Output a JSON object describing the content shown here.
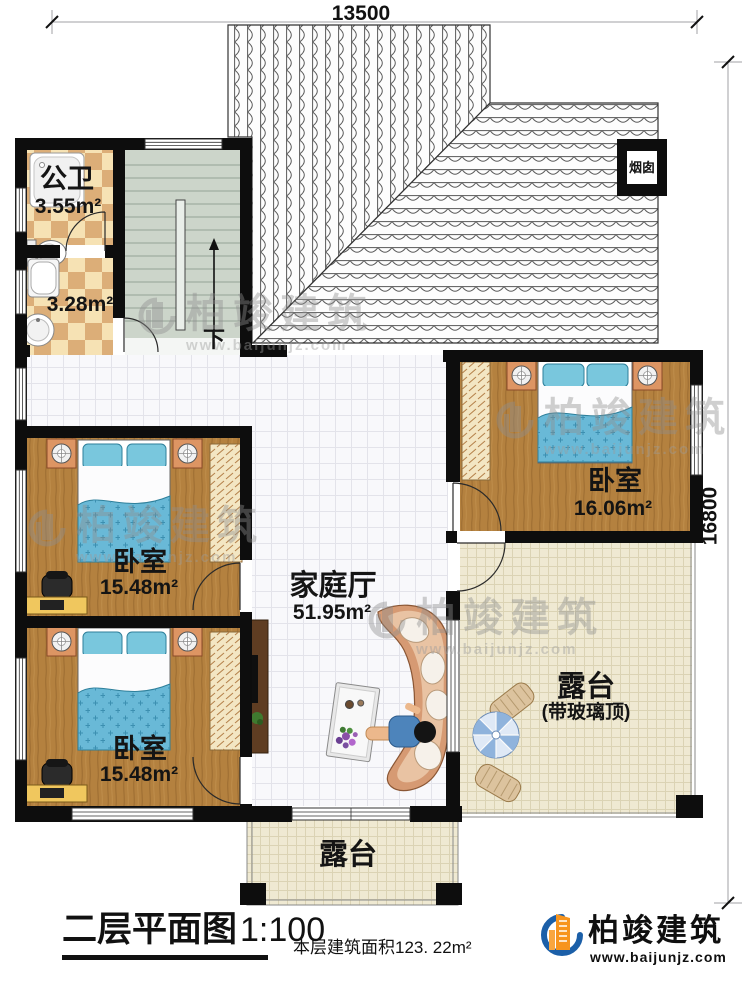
{
  "dimensions": {
    "top": "13500",
    "right": "16800"
  },
  "rooms": {
    "public_bath": {
      "name": "公卫",
      "area": "3.55m²"
    },
    "bath_small": {
      "area": "3.28m²"
    },
    "chimney": {
      "label": "烟囱"
    },
    "stairs": {
      "direction": "下"
    },
    "family_hall": {
      "name": "家庭厅",
      "area": "51.95m²"
    },
    "bedroom_right": {
      "name": "卧室",
      "area": "16.06m²"
    },
    "bedroom_mid": {
      "name": "卧室",
      "area": "15.48m²"
    },
    "bedroom_bottom": {
      "name": "卧室",
      "area": "15.48m²"
    },
    "terrace_right": {
      "name": "露台",
      "note": "(带玻璃顶)"
    },
    "terrace_bottom": {
      "name": "露台"
    }
  },
  "footer": {
    "plan_title": "二层平面图",
    "plan_scale": "1:100",
    "area_note": "本层建筑面积123. 22m²"
  },
  "brand": {
    "name": "柏竣建筑",
    "url": "www.baijunjz.com"
  },
  "watermark": {
    "name": "柏竣建筑",
    "url": "www.baijunjz.com"
  },
  "colors": {
    "wall": "#0d0d0d",
    "wood_floor": "#b4813f",
    "quilt_blue": "#69b9d7",
    "checker_tan": "#dcae78",
    "terrace_floor": "#efe9d2",
    "stairs_floor": "#ccd5ca",
    "brand_orange": "#f7941d",
    "brand_blue": "#1b5fa8"
  }
}
